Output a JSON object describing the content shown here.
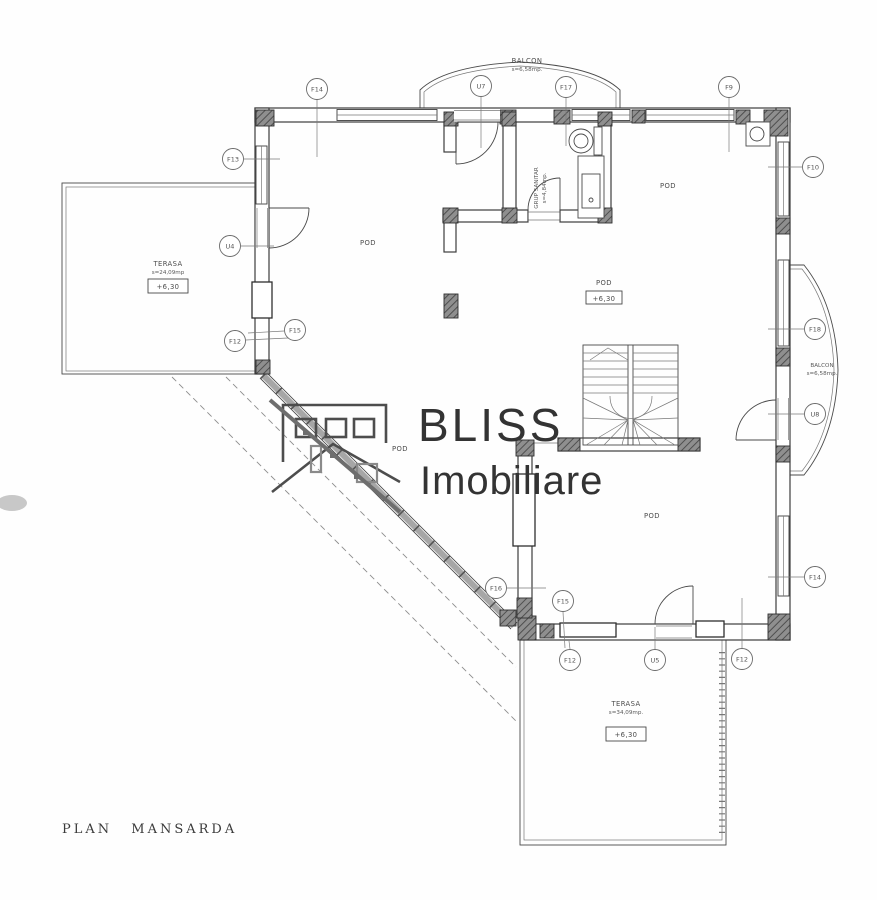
{
  "title": "PLAN MANSARDA",
  "logo": {
    "name": "BLISS",
    "subtitle": "Imobiliare"
  },
  "rooms": {
    "balcon_top": {
      "name": "BALCON",
      "area": "s=6,58mp."
    },
    "balcon_right": {
      "name": "BALCON",
      "area": "s=6,58mp."
    },
    "terasa_left": {
      "name": "TERASA",
      "area": "s=24,09mp",
      "level": "+6,30"
    },
    "terasa_bottom": {
      "name": "TERASA",
      "area": "s=34,09mp.",
      "level": "+6,30"
    },
    "grup_sanitar": {
      "name": "GRUP SANITAR",
      "area": "s=4,84mp."
    },
    "pod_center": {
      "name": "POD",
      "level": "+6,30"
    }
  },
  "plan": {
    "pod_labels": [
      {
        "text": "POD",
        "x": 368,
        "y": 245
      },
      {
        "text": "POD",
        "x": 668,
        "y": 188
      },
      {
        "text": "POD",
        "x": 400,
        "y": 451
      },
      {
        "text": "POD",
        "x": 652,
        "y": 518
      }
    ],
    "markers": [
      {
        "label": "F14",
        "x": 317,
        "y": 89,
        "line": [
          317,
          100,
          317,
          157
        ]
      },
      {
        "label": "U7",
        "x": 481,
        "y": 86,
        "line": [
          481,
          97,
          481,
          148
        ]
      },
      {
        "label": "F17",
        "x": 566,
        "y": 87,
        "line": [
          566,
          98,
          566,
          146
        ]
      },
      {
        "label": "F9",
        "x": 729,
        "y": 87,
        "line": [
          729,
          98,
          729,
          152
        ]
      },
      {
        "label": "F13",
        "x": 233,
        "y": 159,
        "line": [
          244,
          159,
          280,
          159
        ]
      },
      {
        "label": "F10",
        "x": 813,
        "y": 167,
        "line": [
          802,
          167,
          768,
          167
        ]
      },
      {
        "label": "U4",
        "x": 230,
        "y": 246,
        "line": [
          241,
          246,
          274,
          246
        ]
      },
      {
        "label": "F15",
        "x": 295,
        "y": 330,
        "line": [
          284,
          331,
          248,
          333
        ]
      },
      {
        "label": "F12",
        "x": 235,
        "y": 341,
        "line": [
          246,
          340,
          288,
          338
        ]
      },
      {
        "label": "F18",
        "x": 815,
        "y": 329,
        "line": [
          804,
          329,
          768,
          329
        ]
      },
      {
        "label": "U8",
        "x": 815,
        "y": 414,
        "line": [
          804,
          414,
          768,
          414
        ]
      },
      {
        "label": "F16",
        "x": 496,
        "y": 588,
        "line": [
          507,
          588,
          546,
          588
        ]
      },
      {
        "label": "F15",
        "x": 563,
        "y": 601,
        "line": [
          563,
          612,
          565,
          648
        ]
      },
      {
        "label": "F12",
        "x": 570,
        "y": 660,
        "line": [
          570,
          649,
          569,
          641
        ]
      },
      {
        "label": "U5",
        "x": 655,
        "y": 660,
        "line": [
          655,
          649,
          655,
          627
        ]
      },
      {
        "label": "F14",
        "x": 815,
        "y": 577,
        "line": [
          804,
          577,
          768,
          577
        ]
      },
      {
        "label": "F12",
        "x": 742,
        "y": 659,
        "line": [
          742,
          648,
          742,
          598
        ]
      }
    ]
  }
}
